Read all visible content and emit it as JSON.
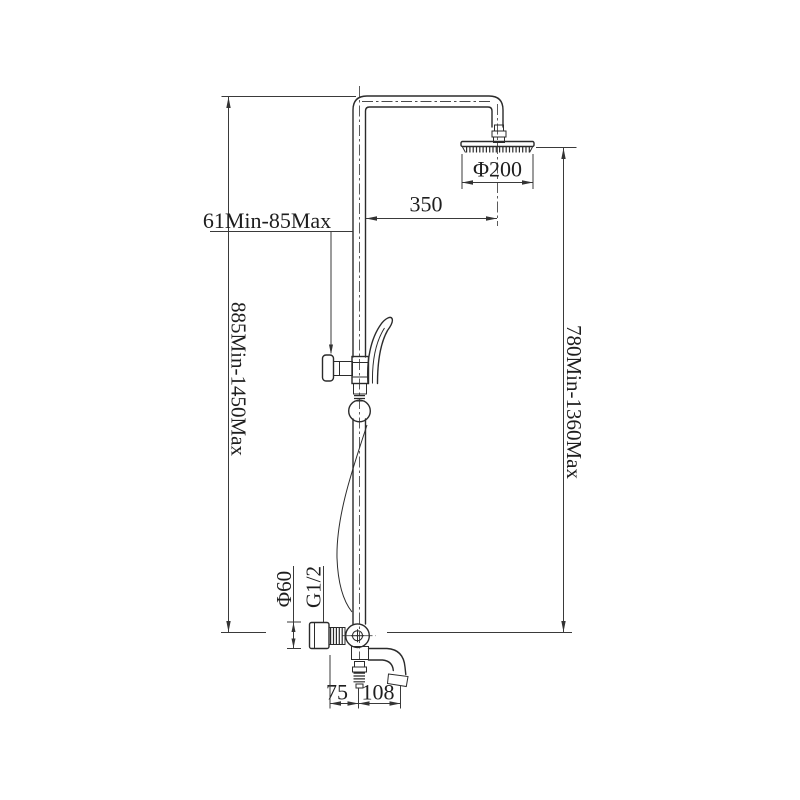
{
  "drawing": {
    "background": "#ffffff",
    "line_color": "#2b2b2b",
    "dimension_color": "#3a3a3a",
    "labels": {
      "head_diameter": "Φ200",
      "head_offset": "350",
      "holder_range": "61Min-85Max",
      "overall_height_range": "885Min-1450Max",
      "head_height_range": "780Min-1360Max",
      "handle_diameter": "Φ60",
      "thread_size": "G1/2",
      "dim_left": "75",
      "dim_reach": "108"
    }
  }
}
